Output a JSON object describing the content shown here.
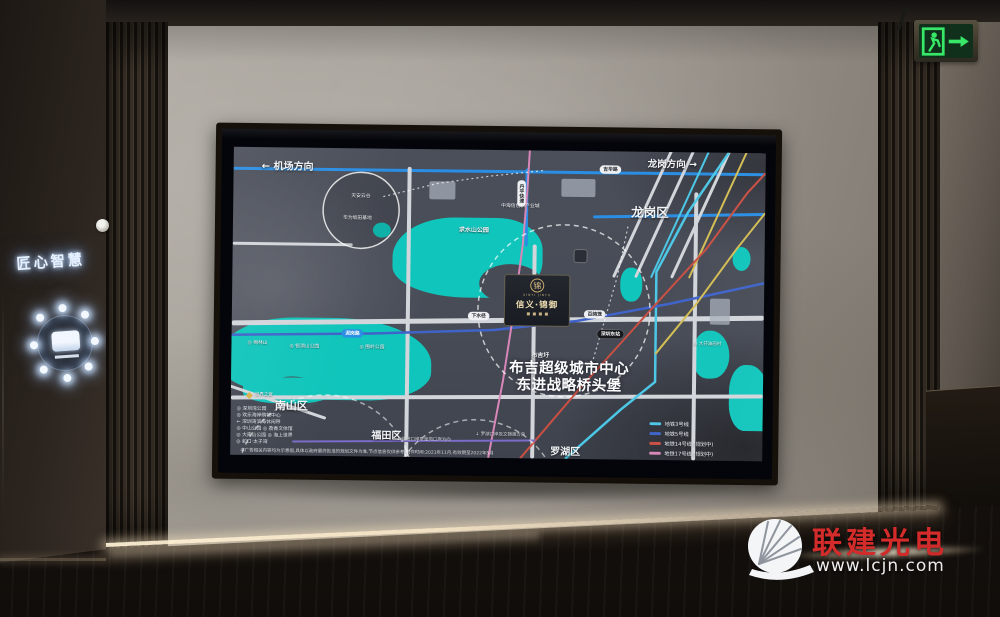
{
  "photo": {
    "exit_sign": {
      "icon": "running-man-exit-arrow-right"
    },
    "wall_sign": {
      "text": "匠心智慧",
      "logo_icon": "illuminated-ring-emblem"
    },
    "watermark": {
      "brand": "联建光电",
      "url": "www.lcjn.com",
      "brand_color": "#d42b2b",
      "logo_icon": "fan-shutter-disc"
    }
  },
  "map": {
    "dir_left": "← 机场方向",
    "dir_right": "龙岗方向 →",
    "district_longgang": "龙岗区",
    "district_nanshan": "南山区",
    "district_futian": "福田区",
    "district_luohu": "罗湖区",
    "slogan_tag": "布吉圩",
    "slogan_line1": "布吉超级城市中心",
    "slogan_line2": "东进战略桥头堡",
    "project": {
      "emblem": "锦",
      "latin": "XINYI JINYU",
      "name": "信义·锦御"
    },
    "roads": {
      "jihua": "吉华路",
      "nigang": "泥岗路",
      "danping": "丹平快速"
    },
    "stations": [
      "下水径",
      "上水径",
      "百鸽笼"
    ],
    "station_east": "深圳东站",
    "industry_park": "中海信创新产业城",
    "circle_poi": {
      "line1": "天安云谷",
      "line2": "华为坂田基地"
    },
    "parks": {
      "qiushui": "求水山公园",
      "meilin": "◎ 梅林山",
      "yinhu": "◎ 银湖山公园",
      "weiling": "◎ 围岭公园",
      "dafen": "◎ 大芬油画村"
    },
    "poi_worldwindow": "世界之窗",
    "poi_rows": [
      "◎ 深圳湾公园",
      "◎ 欢乐海岸购物中心",
      "← 深圳湾滨海休闲带",
      "◎ 中山公园 ◎ 荔香文体馆",
      "◎ 大南山公园 ◎ 海上世界",
      "◎ 蛇口·太子湾"
    ],
    "note_futian": "↓ 福田口岸及皇岗口岸方向",
    "note_luohu": "↓ 罗湖口岸及文锦渡方向",
    "legend_items": [
      {
        "label": "地铁3号线",
        "color": "#4cc7e6"
      },
      {
        "label": "地铁5号线",
        "color": "#3f63c9"
      },
      {
        "label": "地铁14号线 (规划中)",
        "color": "#c94f43"
      },
      {
        "label": "地铁17号线 (规划中)",
        "color": "#d887b8"
      },
      {
        "label": "地铁27号线 (规划中)",
        "color": "#d3bd55"
      }
    ],
    "disclaimer": "本广告相关内容均为示意图,具体以政府最终批准的规划文件为准,节点信息仅供参考,制作时间:2021年11月,有效期至2022年5月"
  }
}
